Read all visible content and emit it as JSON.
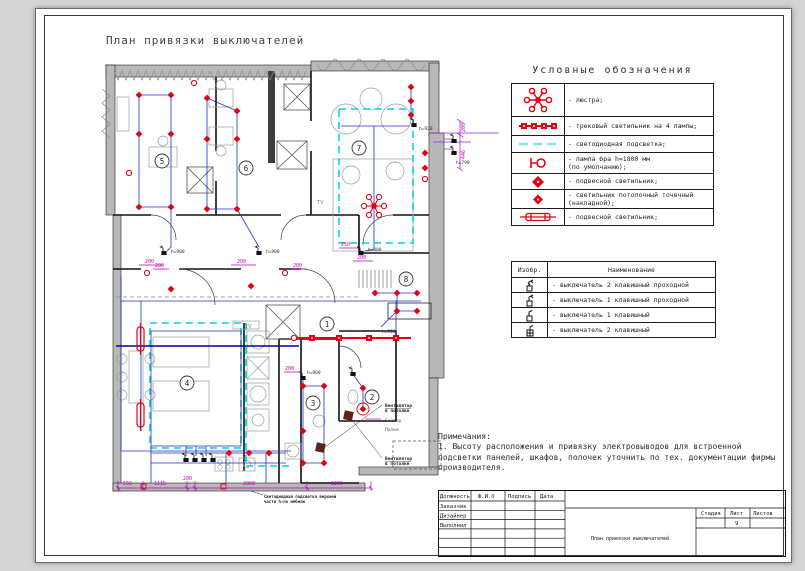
{
  "drawing": {
    "title": "План привязки выключателей"
  },
  "legend": {
    "title": "Условные обозначения",
    "items": [
      {
        "icon": "chandelier-icon",
        "label": "- люстра;"
      },
      {
        "icon": "track-light-icon",
        "label": "- трековый светильник на 4 лампы;"
      },
      {
        "icon": "led-strip-icon",
        "label": "- светодиодная подсветка;"
      },
      {
        "icon": "sconce-icon",
        "label": "- лампа бра h=1800 мм\n(по умолчанию);"
      },
      {
        "icon": "pendant-light-icon",
        "label": "- подвесной светильник;"
      },
      {
        "icon": "spot-light-icon",
        "label": "- светильник потолочный точечный\n(накладной);"
      },
      {
        "icon": "linear-pendant-icon",
        "label": "- подвесной светильник;"
      }
    ]
  },
  "switch_table": {
    "col_symbol": "Изобр.",
    "col_name": "Наименование",
    "rows": [
      {
        "label": "- выключатель 2 клавишный проходной"
      },
      {
        "label": "- выключатель 1 клавишный проходной"
      },
      {
        "label": "- выключатель 1 клавишный"
      },
      {
        "label": "- выключатель 2 клавишный"
      }
    ]
  },
  "notes": {
    "heading": "Примечания:",
    "text": "1.  Высоту расположения и привязку электровыводов для встроенной подсветки панелей, шкафов, полочек уточнить по тех. документации фирмы производителя."
  },
  "titleblock": {
    "col_position": "Должность",
    "col_name": "Ф.И.О",
    "col_sign": "Подпись",
    "col_date": "Дата",
    "row_customer": "Заказчик",
    "row_designer": "Дизайнер",
    "row_executor": "Выполнил",
    "stage": "Стадия",
    "sheet": "Лист",
    "sheets": "Листов",
    "sheet_number": "9",
    "doc_title": "План привязки выключателей"
  },
  "plan": {
    "rooms": [
      "1",
      "2",
      "3",
      "4",
      "5",
      "6",
      "7",
      "8"
    ],
    "dims_bottom": [
      "550",
      "1115",
      "200",
      "2000",
      "1200"
    ],
    "dim_200": "200",
    "dim_250": "250",
    "dim_446": "446",
    "h900": "h=900",
    "h800": "h=800",
    "h790": "h=790",
    "h920": "h=920",
    "tv": "TV",
    "fan_line1": "Вентилятор",
    "fan_line2": "в потолке",
    "boiler": "Бойлер",
    "shelves": "Полки",
    "led_line1": "Светодиодная подсветка верхней",
    "led_line2": "части h-по мебели"
  }
}
